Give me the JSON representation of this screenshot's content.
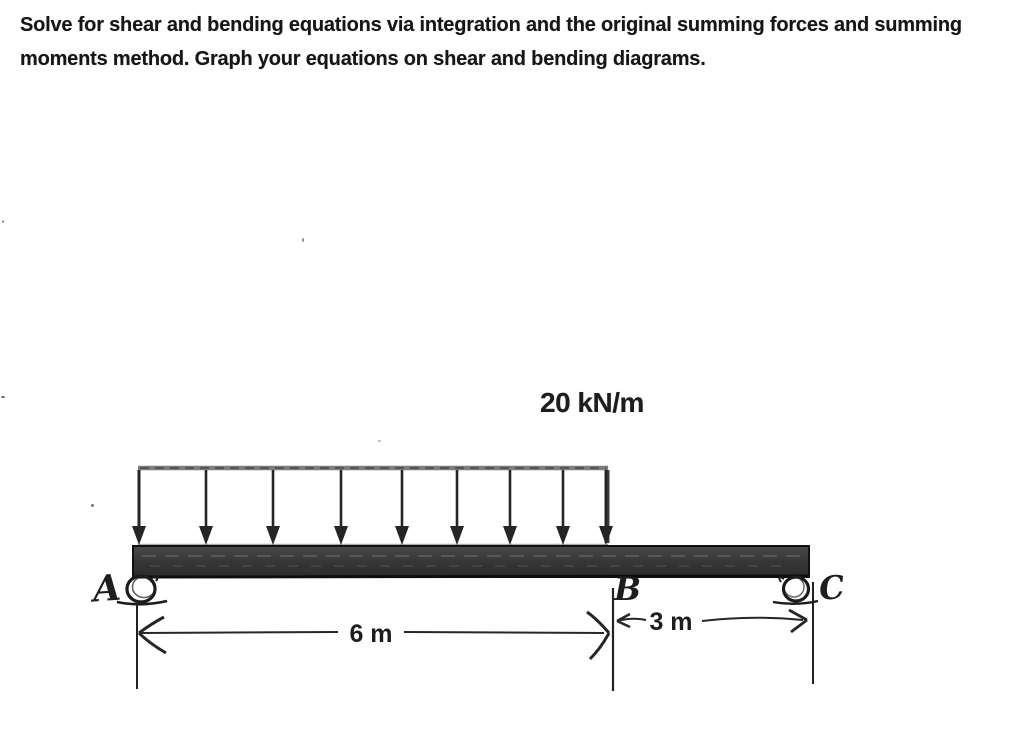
{
  "problem": {
    "line1": "Solve for shear and bending equations via integration and the original summing forces and summing",
    "line2": "moments method. Graph your equations on shear and bending diagrams."
  },
  "diagram": {
    "load_label": "20 kN/m",
    "load": {
      "arrow_count": 9
    },
    "labels": {
      "support_left": "A",
      "point_mid": "B",
      "support_right": "C"
    },
    "dimensions": {
      "span_left": "6 m",
      "span_right": "3 m"
    },
    "colors": {
      "ink": "#222222",
      "beam_dark": "#3a3a3a",
      "load_line_gray": "#7d7d7d"
    }
  }
}
